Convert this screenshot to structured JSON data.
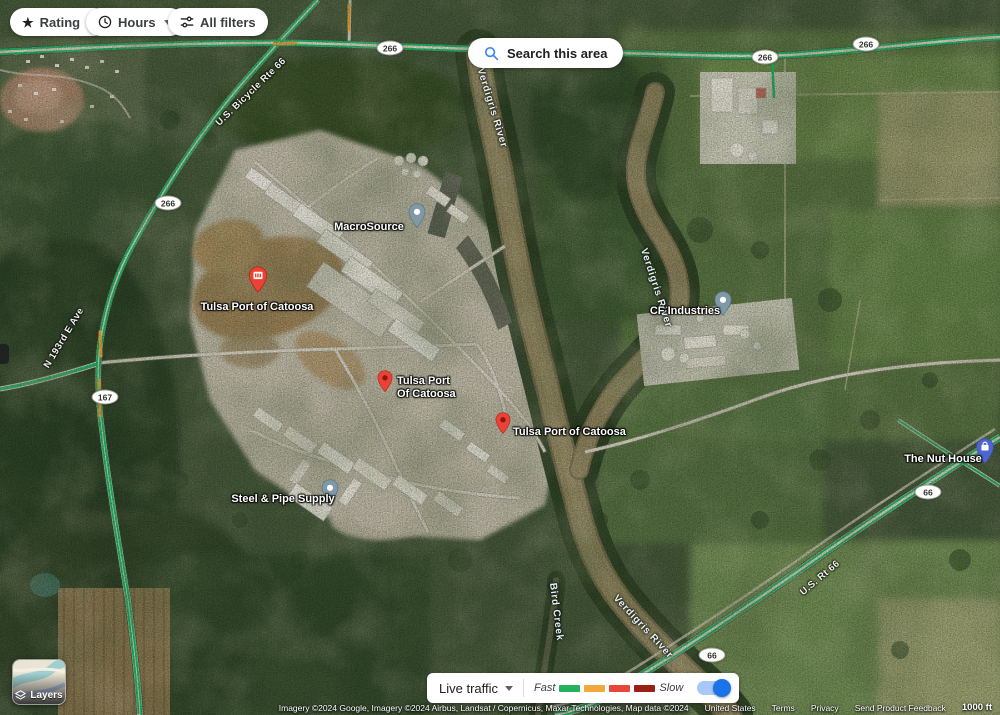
{
  "filters": {
    "rating_label": "Rating",
    "hours_label": "Hours",
    "all_filters_label": "All filters"
  },
  "search_area": {
    "label": "Search this area"
  },
  "map_labels": {
    "macrosource": "MacroSource",
    "tulsa_port_1": "Tulsa Port of Catoosa",
    "tulsa_port_2_line1": "Tulsa Port",
    "tulsa_port_2_line2": "Of Catoosa",
    "tulsa_port_3": "Tulsa Port of Catoosa",
    "cf_industries": "CF Industries",
    "steel_pipe": "Steel & Pipe Supply",
    "nut_house": "The Nut House"
  },
  "road_labels": {
    "bicycle_rte_66": "U.S. Bicycle Rte 66",
    "us_rt_66": "U.S. Rt 66",
    "n_193rd_e_ave": "N 193rd E Ave",
    "shield_266": "266",
    "shield_167": "167",
    "shield_66": "66"
  },
  "water_labels": {
    "verdigris_top": "Verdigris River",
    "verdigris_mid": "Verdigris River",
    "verdigris_bottom": "Verdigris River",
    "bird_creek": "Bird Creek"
  },
  "layers_control": {
    "label": "Layers"
  },
  "traffic": {
    "label": "Live traffic",
    "fast": "Fast",
    "slow": "Slow",
    "colors": [
      "#24b35b",
      "#f2a93b",
      "#e8453c",
      "#9a2014"
    ],
    "toggle_color": "#1a73e8",
    "toggle_on": true
  },
  "attribution": {
    "imagery": "Imagery ©2024 Google, Imagery ©2024 Airbus, Landsat / Copernicus, Maxar Technologies, Map data ©2024",
    "country": "United States",
    "terms": "Terms",
    "privacy": "Privacy",
    "feedback": "Send Product Feedback",
    "scale": "1000 ft"
  }
}
